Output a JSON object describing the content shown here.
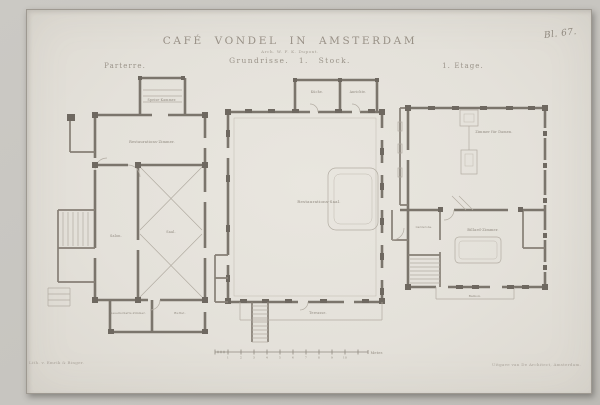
{
  "plate_number": "Bl. 67.",
  "header": {
    "title": "CAFÉ VONDEL IN AMSTERDAM",
    "architect_line": "Arch. W. F. K. Dupont.",
    "subtitle": "Grundrisse.  1. Stock."
  },
  "plans": {
    "parterre": {
      "label": "Parterre.",
      "rooms": {
        "speisekammer": "Speise-Kammer.",
        "restauration": "Restaurations-Zimmer.",
        "salon": "Salon.",
        "saal": "Saal.",
        "gesellschaft": "Gesellschafts-Zimmer.",
        "buffet": "Buffet."
      }
    },
    "saalbau": {
      "rooms": {
        "kueche": "Küche.",
        "anrichte": "Anrichte.",
        "saal": "Restaurations-Saal.",
        "terrasse": "Terrasse."
      }
    },
    "etage": {
      "label": "1. Etage.",
      "rooms": {
        "damen": "Zimmer für Damen.",
        "garderobe": "Garderobe.",
        "billard": "Billard-Zimmer.",
        "balkon": "Balkon."
      }
    }
  },
  "scale_bar": {
    "ticks": [
      "1",
      "2",
      "3",
      "4",
      "5",
      "6",
      "7",
      "8",
      "9",
      "10"
    ],
    "unit": "Meter."
  },
  "imprints": {
    "left": "Lith. v. Emrik & Binger.",
    "right": "Uitgave van De Architect, Amsterdam."
  },
  "colors": {
    "paper": "#e4e1da",
    "background": "#c6c4bf",
    "ink_walls": "#7b756c",
    "ink_text": "#948d83"
  }
}
